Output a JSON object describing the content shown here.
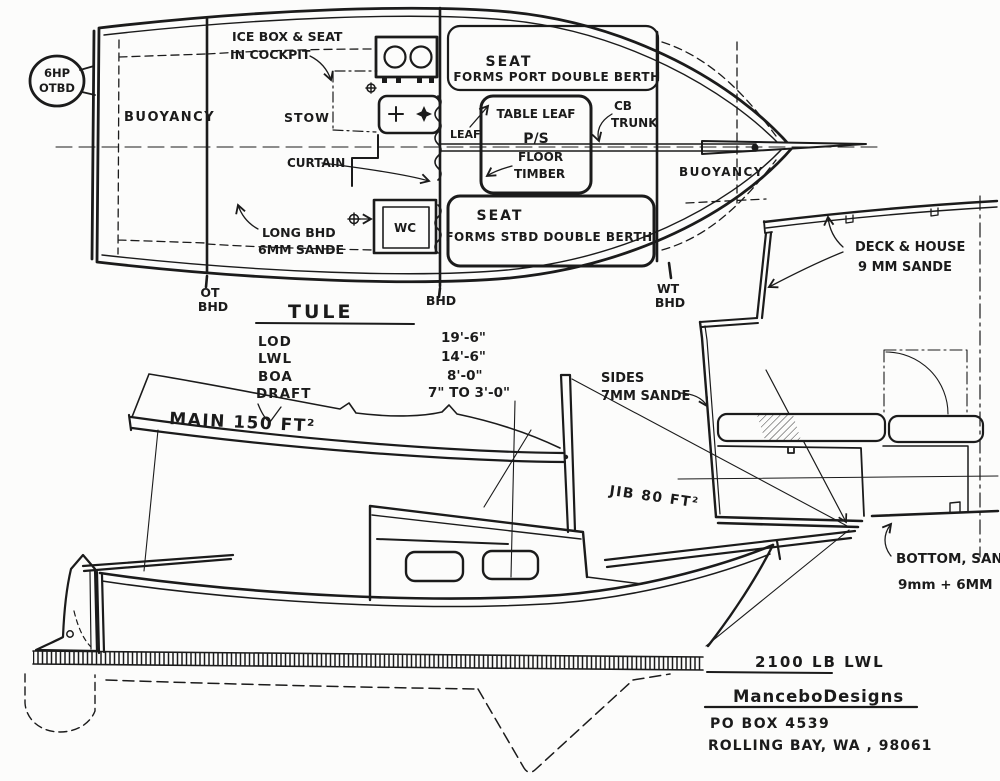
{
  "colors": {
    "ink": "#1b1b1b",
    "paper": "#fcfcfb"
  },
  "plan_view": {
    "engine_note": {
      "line1": "6HP",
      "line2": "OTBD"
    },
    "buoyancy_aft": "BUOYANCY",
    "buoyancy_fwd": "BUOYANCY",
    "icebox_note": {
      "line1": "ICE BOX & SEAT",
      "line2": "IN COCKPIT"
    },
    "stow": "STOW",
    "curtain": "CURTAIN",
    "leaf": "LEAF",
    "port_berth": {
      "line1": "SEAT",
      "line2": "FORMS PORT DOUBLE BERTH"
    },
    "stbd_berth": {
      "line1": "SEAT",
      "line2": "FORMS STBD DOUBLE BERTH"
    },
    "table": {
      "line1": "TABLE LEAF",
      "line2": "P/S"
    },
    "cb_trunk": {
      "line1": "CB",
      "line2": "TRUNK"
    },
    "floor_timber": {
      "line1": "FLOOR",
      "line2": "TIMBER"
    },
    "wc": "WC",
    "long_bhd": {
      "line1": "LONG BHD",
      "line2": "6MM SANDE"
    },
    "bhd_aft": {
      "line1": "OT",
      "line2": "BHD"
    },
    "bhd_mid": "BHD",
    "bhd_fwd": {
      "line1": "WT",
      "line2": "BHD"
    }
  },
  "specs": {
    "boat_name": "TULE",
    "rows": [
      {
        "label": "LOD",
        "value": "19'-6\""
      },
      {
        "label": "LWL",
        "value": "14'-6\""
      },
      {
        "label": "BOA",
        "value": "8'-0\""
      },
      {
        "label": "DRAFT",
        "value": "7\" TO 3'-0\""
      }
    ]
  },
  "profile_view": {
    "main_sail": "MAIN 150 FT²",
    "jib_sail": "JIB 80 FT²",
    "displacement": "2100 LB LWL"
  },
  "section_view": {
    "deck_note": {
      "line1": "DECK & HOUSE",
      "line2": "9 MM SANDE"
    },
    "sides_note": {
      "line1": "SIDES",
      "line2": "7MM SANDE"
    },
    "bottom_note": {
      "line1": "BOTTOM, SANDE",
      "line2": "9mm + 6MM"
    }
  },
  "title_block": {
    "designer": "ManceboDesigns",
    "address_line1": "PO BOX 4539",
    "address_line2": "ROLLING BAY, WA , 98061"
  }
}
